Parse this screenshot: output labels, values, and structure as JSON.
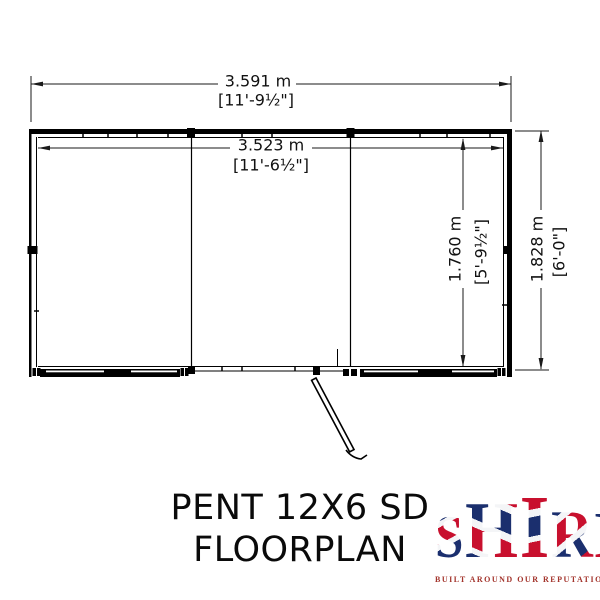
{
  "page": {
    "background": "#ffffff",
    "line_color": "#000000"
  },
  "floorplan": {
    "dimensions": {
      "outer_width": {
        "metric": "3.591 m",
        "imperial": "[11'-9½\"]"
      },
      "inner_width": {
        "metric": "3.523 m",
        "imperial": "[11'-6½\"]"
      },
      "inner_depth": {
        "metric": "1.760 m",
        "imperial": "[5'-9½\"]"
      },
      "outer_depth": {
        "metric": "1.828 m",
        "imperial": "[6'-0\"]"
      }
    }
  },
  "title": {
    "line1": "PENT 12X6 SD",
    "line2": "FLOORPLAN"
  },
  "logo": {
    "letters": [
      "S",
      "H",
      "I",
      "R",
      "E"
    ],
    "tagline": "BUILT AROUND OUR REPUTATION",
    "colors": {
      "red": "#c8102e",
      "blue": "#1b2f6e",
      "white": "#ffffff",
      "tagline_red": "#a3342c"
    }
  }
}
